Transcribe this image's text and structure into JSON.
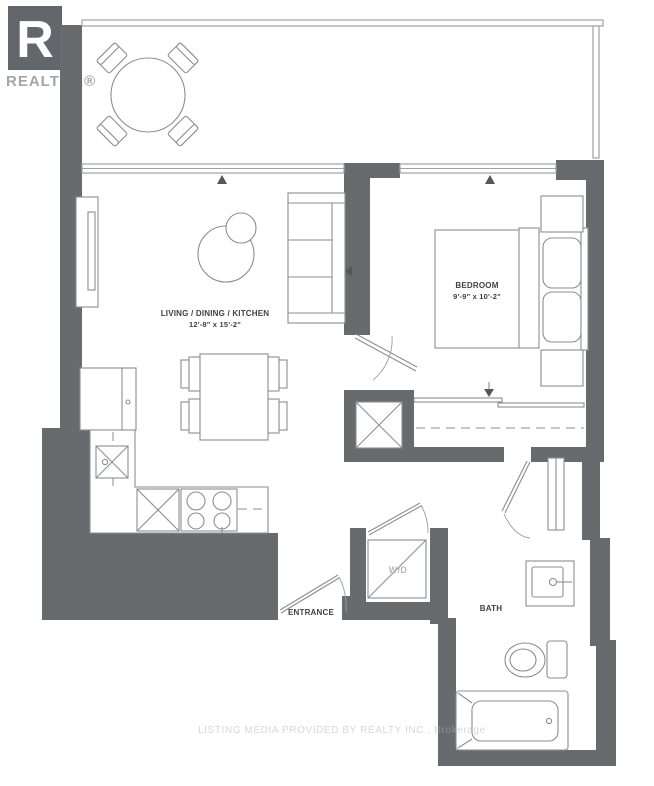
{
  "logo": {
    "letter": "R",
    "brand": "REALTOR®"
  },
  "rooms": {
    "living": {
      "name": "LIVING / DINING / KITCHEN",
      "dims": "12'-8\" x 15'-2\""
    },
    "bedroom": {
      "name": "BEDROOM",
      "dims": "9'-9\" x 10'-2\""
    },
    "bath": {
      "name": "BATH"
    },
    "entrance": {
      "name": "ENTRANCE"
    },
    "laundry": {
      "name": "W/D"
    }
  },
  "watermark": "LISTING MEDIA PROVIDED BY REALTY INC., Brokerage",
  "colors": {
    "wall": "#686b6e",
    "furniture_line": "#8b8e91",
    "railing_line": "#9ea1a4",
    "label_text": "#3f4143",
    "logo_box": "#63666a",
    "logo_text": "#a2a5a8",
    "wd_text": "#b6b9bc",
    "background": "#ffffff"
  }
}
